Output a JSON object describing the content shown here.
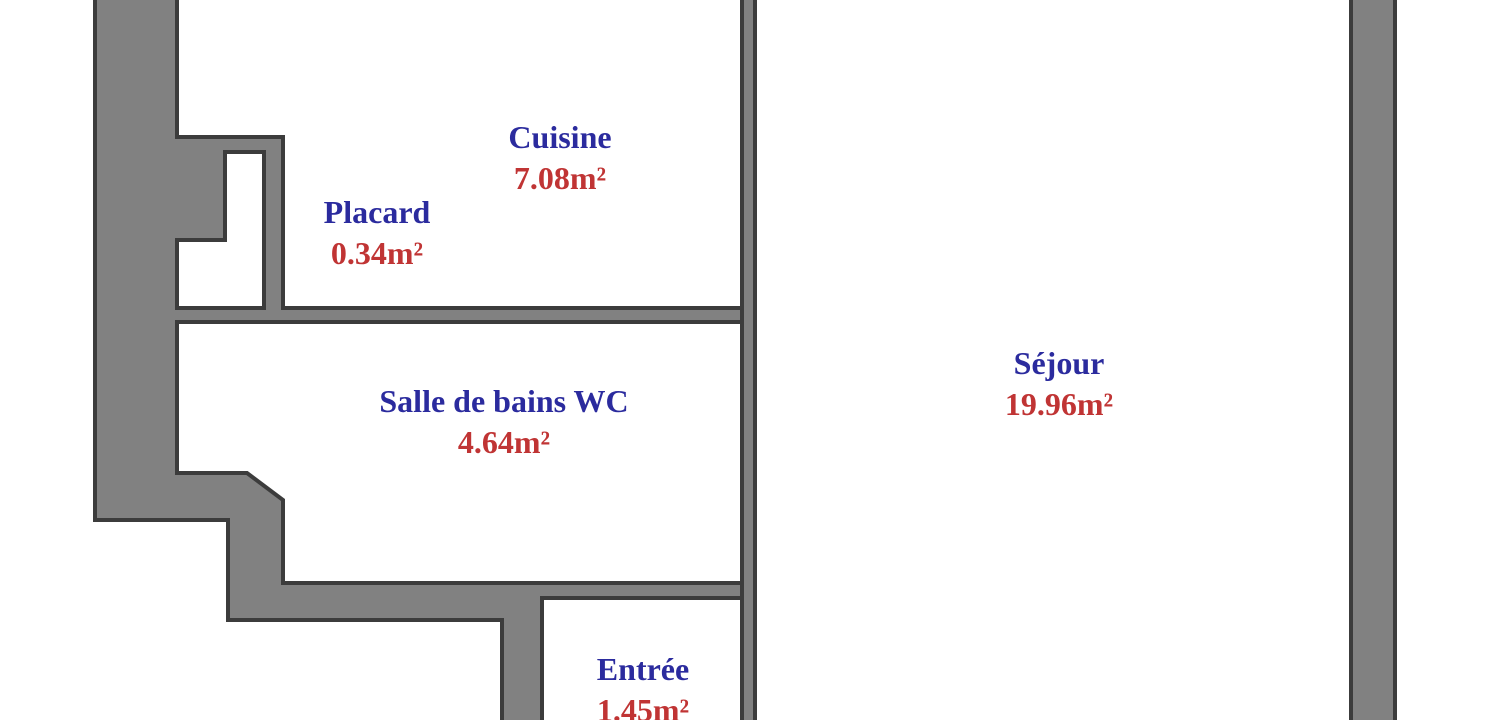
{
  "document": {
    "type": "apartment-floor-plan"
  },
  "rooms": [
    {
      "id": "cuisine",
      "name": "Cuisine",
      "area": "7.08m²"
    },
    {
      "id": "placard",
      "name": "Placard",
      "area": "0.34m²"
    },
    {
      "id": "salle-de-bains",
      "name": "Salle de bains WC",
      "area": "4.64m²"
    },
    {
      "id": "sejour",
      "name": "Séjour",
      "area": "19.96m²"
    },
    {
      "id": "entree",
      "name": "Entrée",
      "area": "1.45m²"
    }
  ],
  "colors": {
    "room_name": "#2b2b9e",
    "room_area": "#c03434",
    "wall_fill": "#818181",
    "wall_outline": "#3c3c3c",
    "background": "#ffffff"
  }
}
